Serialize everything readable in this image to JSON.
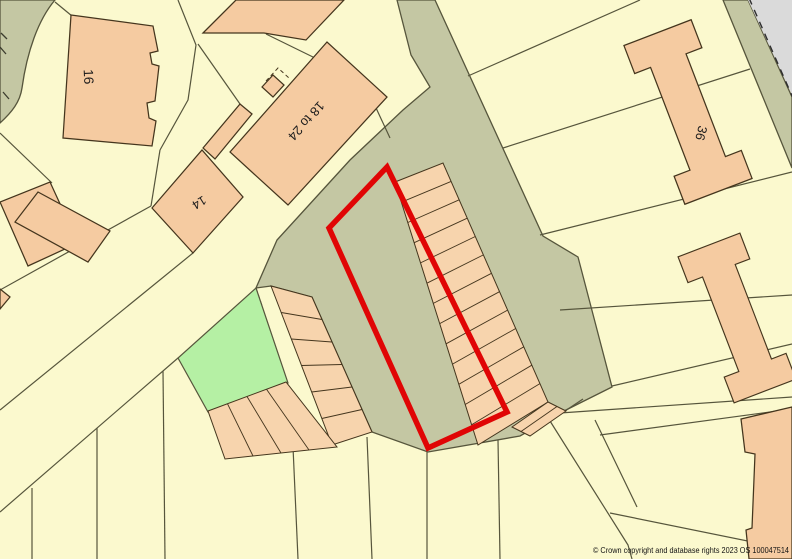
{
  "map": {
    "type": "ordnance-survey-site-plan",
    "attribution": "© Crown copyright and database rights 2023 OS 100047514",
    "labels": {
      "building_16": "16",
      "building_18_to_24": "18 to 24",
      "building_14": "14",
      "building_36": "36"
    },
    "features": {
      "site_boundary": "red plot outline around garage court",
      "green_space": "small green amenity parcel",
      "garage_rows": 3
    }
  },
  "colors": {
    "parcel": "#fbf9ce",
    "road": "#c4c7a3",
    "building": "#f5cba1",
    "garage": "#f7d4ad",
    "green_space": "#b5f0a4",
    "plot_outline": "#e00505",
    "offmap": "#dadada",
    "line": "#56553c",
    "building_stroke": "#44351d"
  }
}
